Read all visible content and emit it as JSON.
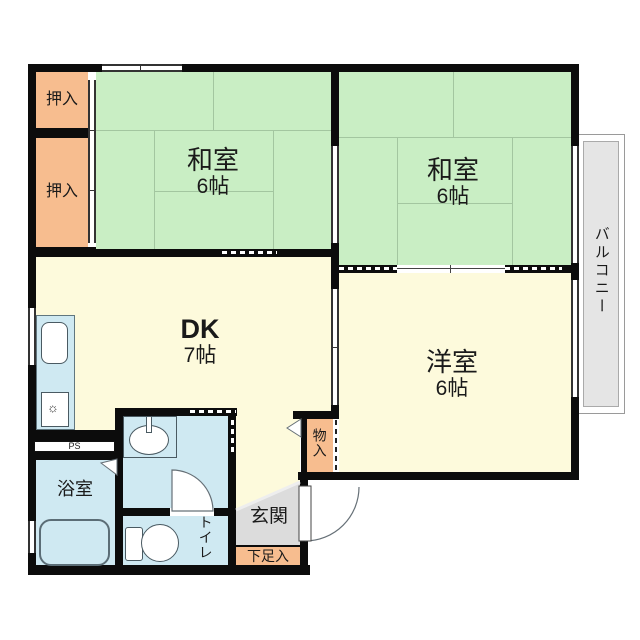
{
  "floorplan": {
    "rooms": {
      "oshiire1": {
        "label": "押入"
      },
      "oshiire2": {
        "label": "押入"
      },
      "washitsu1": {
        "name": "和室",
        "size": "6帖"
      },
      "washitsu2": {
        "name": "和室",
        "size": "6帖"
      },
      "dk": {
        "name": "DK",
        "size": "7帖"
      },
      "yoshitsu": {
        "name": "洋室",
        "size": "6帖"
      },
      "balcony": {
        "label": "バルコニー"
      },
      "bathroom": {
        "label": "浴室"
      },
      "toilet": {
        "label": "トイレ"
      },
      "storage": {
        "label": "物入"
      },
      "genkan": {
        "label": "玄関"
      },
      "shoe_storage": {
        "label": "下足入"
      },
      "pipe_space": {
        "label": "PS"
      }
    },
    "colors": {
      "tatami_green": "#c9eec4",
      "flooring_yellow": "#fdfadc",
      "closet_orange": "#f7bd8f",
      "wet_area_blue": "#cfe9f2",
      "balcony_gray": "#e5e5e5",
      "genkan_gray": "#dcdcdc",
      "wall_black": "#0c0c0c"
    }
  }
}
